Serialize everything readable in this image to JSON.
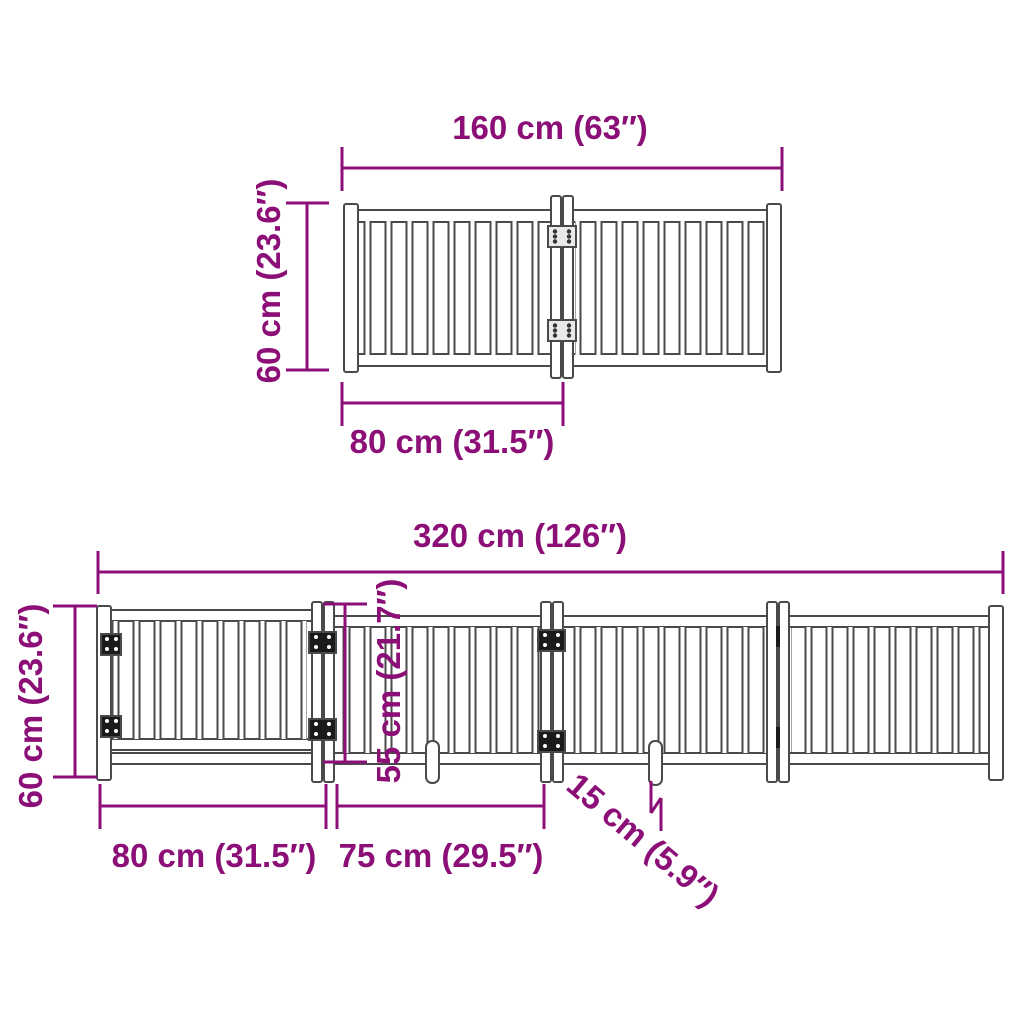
{
  "colors": {
    "dimension_purple": "#8C0F78",
    "line_gray": "#4A4A4A",
    "hinge_dark": "#1A1A1A",
    "background": "#FFFFFF"
  },
  "top_view": {
    "total_width_label": "160 cm (63″)",
    "height_label": "60 cm (23.6″)",
    "panel_width_label": "80 cm (31.5″)"
  },
  "bottom_view": {
    "total_width_label": "320 cm (126″)",
    "height_label": "60 cm (23.6″)",
    "door_height_label": "55 cm (21.7″)",
    "first_panel_width_label": "80 cm (31.5″)",
    "second_panel_width_label": "75 cm (29.5″)",
    "foot_length_label": "15 cm (5.9″)"
  }
}
